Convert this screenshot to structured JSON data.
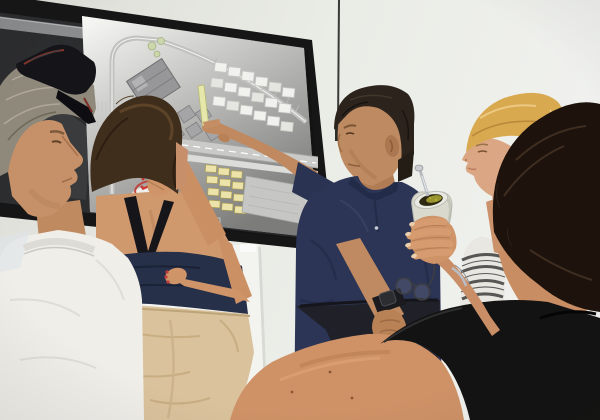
{
  "scene": {
    "type": "photograph",
    "description": "Five people in a bright meeting room review a large printed urban site plan taped over a wall-mounted dark display; a man in a navy polo points at the plan while a foreground woman holds a yerba mate gourd.",
    "wall_color": "#e9ebe5",
    "floor_color": "#dcd3c2",
    "floor": "beige ceramic tile"
  },
  "display": {
    "visible_text": "ETB",
    "state": "dark screen mostly covered by printed plan sheet",
    "bezel_color": "#161617",
    "screen_color": "#2c2d2f"
  },
  "site_plan": {
    "name": "urban-master-plan-sheet",
    "paper_color": "#f8f8f5",
    "features": [
      "curved perimeter road",
      "large dark-grey main building",
      "cluster of grey warehouse blocks",
      "rows of small outlined plots",
      "yellow-green landscaping strip",
      "diagonal main road with lane line",
      "rows of small yellow buildings",
      "grey parking area",
      "red marker ellipse annotation",
      "small green trees"
    ],
    "annotation_color": "#c23b34",
    "pointed_at": "diagonal main road beside the yellow-green strip"
  },
  "secondary_plan": {
    "name": "lower-plan-sheet",
    "description": "second plan sheet taped to the wall below the display, showing a blue lagoon/pool shape and faint grey blocks",
    "water_color": "#6191cf"
  },
  "people": [
    {
      "id": "left-man",
      "description": "older man, grey hair, sunglasses resting on head, white t-shirt, seen from behind-left"
    },
    {
      "id": "bun-woman",
      "description": "woman with brown hair in a bun, navy tank top, beige trousers, hand raised to her face holding a red pen"
    },
    {
      "id": "pointing-man",
      "description": "man in navy polo and dark trousers pointing at the plan, smartwatch on wrist"
    },
    {
      "id": "blonde-woman",
      "description": "short-haired blonde woman in profile wearing a striped top"
    },
    {
      "id": "foreground-woman",
      "description": "dark-haired woman seen from behind, black top, bare shoulder, holding a white yerba mate gourd with metal bombilla"
    }
  ],
  "objects": [
    {
      "id": "smartboard",
      "description": "large wall-mounted display with black bezel"
    },
    {
      "id": "sunglasses",
      "description": "dark sunglasses perched on grey hair"
    },
    {
      "id": "red-pen",
      "color": "#cf3a32"
    },
    {
      "id": "smartwatch",
      "description": "dark smartwatch on pointing man's wrist"
    },
    {
      "id": "mate-gourd",
      "description": "white gourd with green yerba and silver bombilla straw"
    },
    {
      "id": "eyeglasses",
      "description": "eyeglasses dangling from fingers"
    },
    {
      "id": "bracelet",
      "color": "#b9bcc2"
    },
    {
      "id": "wall-cable",
      "description": "thin dark cable on wall right of display"
    }
  ],
  "palette": {
    "wall": "#e9ebe5",
    "navy_polo": "#2c3555",
    "navy_tank": "#273049",
    "beige_trousers": "#dac29c",
    "black_top": "#121212",
    "white_tee": "#efeee9",
    "blonde_hair": "#d9a94f",
    "map_road": "#cacac8",
    "map_yellow": "#ebe3a9",
    "pool_blue": "#6191cf"
  }
}
